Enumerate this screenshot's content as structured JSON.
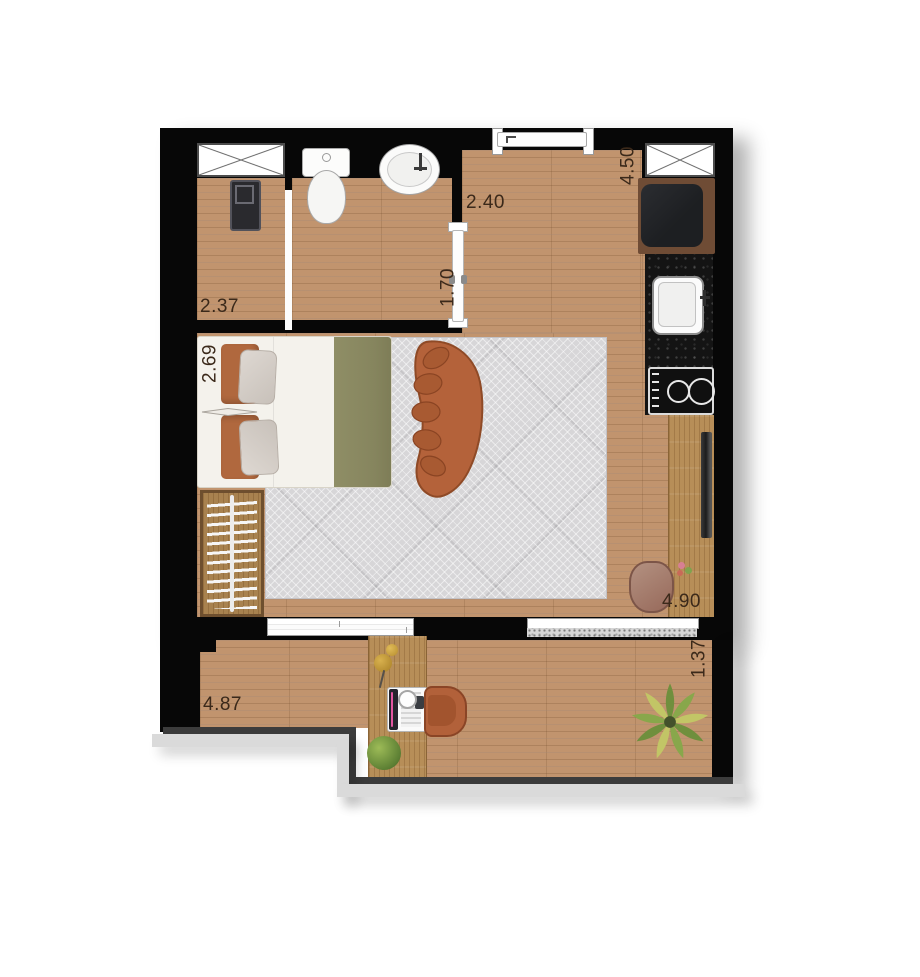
{
  "meta": {
    "type": "apartment floor plan, top view",
    "unit_hint": "meters"
  },
  "colors": {
    "wall": "#070707",
    "floor_wood": "#c1946e",
    "furniture_wood": "#b78e58",
    "rug": "#d7d6d8",
    "sofa_terracotta": "#b4623a",
    "counter_granite": "#141414",
    "blanket_olive": "#8b8a63",
    "cushion_orange": "#b0683e",
    "label_text": "#3b291a",
    "parapet_light": "#dadada"
  },
  "dimensions": {
    "laundry_width": "2.37",
    "bathroom_opening": "1.70",
    "entry_width": "2.40",
    "kitchen_depth": "4.50",
    "bed_wall": "2.69",
    "living_length": "4.90",
    "balcony_depth": "1.37",
    "balcony_width": "4.87"
  },
  "icons": [
    "window-icon",
    "washing-machine-icon",
    "toilet-icon",
    "washbasin-icon",
    "entry-door-icon",
    "pocket-door-icon",
    "fridge-icon",
    "kitchen-sink-icon",
    "cooktop-icon",
    "bar-counter-icon",
    "stool-icon",
    "bed-icon",
    "pillow-icon",
    "sofa-icon",
    "wardrobe-hangers-icon",
    "sliding-door-icon",
    "desk-icon",
    "laptop-icon",
    "desk-lamp-icon",
    "office-chair-icon",
    "plant-icon",
    "palm-plant-icon"
  ]
}
